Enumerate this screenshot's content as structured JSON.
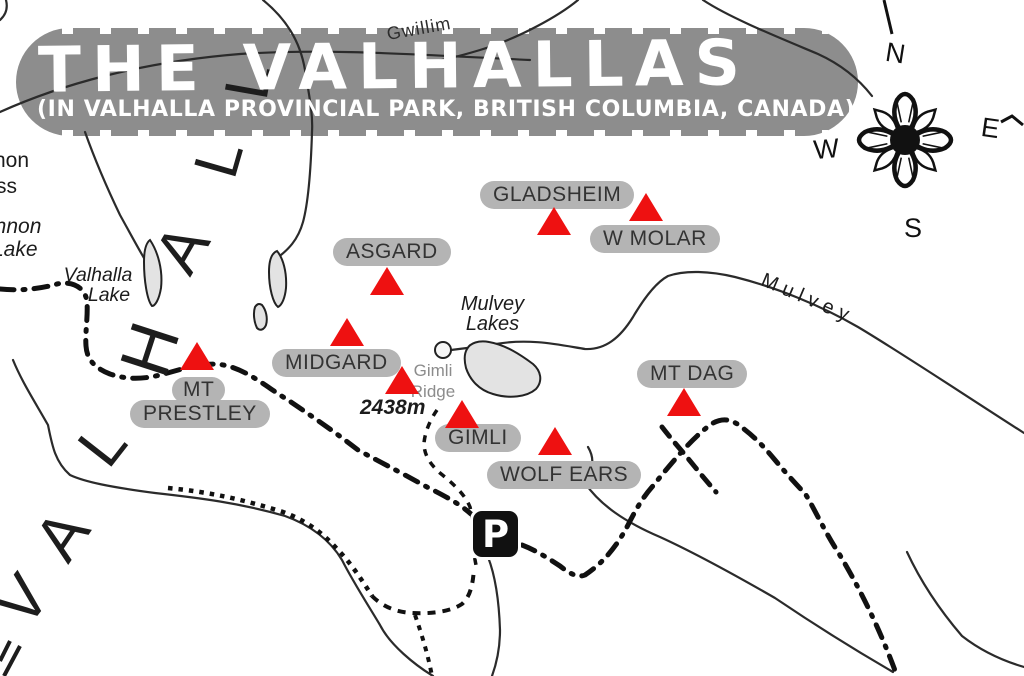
{
  "title": {
    "main": "THE VALHALLAS",
    "subtitle": "(IN VALHALLA PROVINCIAL PARK, BRITISH COLUMBIA, CANADA)"
  },
  "compass": {
    "n": "N",
    "e": "E",
    "s": "S",
    "w": "W"
  },
  "peaks": [
    {
      "id": "gladsheim",
      "label": "GLADSHEIM"
    },
    {
      "id": "w-molar",
      "label": "W MOLAR"
    },
    {
      "id": "asgard",
      "label": "ASGARD"
    },
    {
      "id": "midgard",
      "label": "MIDGARD"
    },
    {
      "id": "mt-prestley",
      "label_line1": "MT",
      "label_line2": "PRESTLEY"
    },
    {
      "id": "gimli-ridge",
      "name_line1": "Gimli",
      "name_line2": "Ridge",
      "elevation": "2438m"
    },
    {
      "id": "gimli",
      "label": "GIMLI"
    },
    {
      "id": "wolf-ears",
      "label": "WOLF EARS"
    },
    {
      "id": "mt-dag",
      "label": "MT DAG"
    }
  ],
  "water": {
    "mulvey_lakes_line1": "Mulvey",
    "mulvey_lakes_line2": "Lakes",
    "valhalla_lake_line1": "Valhalla",
    "valhalla_lake_line2": "Lake"
  },
  "creeks": {
    "mulvey_creek": "Mulvey",
    "gwillim_creek": "Gwillim"
  },
  "edge_labels": {
    "fragment_top": "non",
    "fragment_second": "ss",
    "fragment_lake_line1": "innon",
    "fragment_lake_line2": "Lake"
  },
  "big_letters": {
    "word": "VALHALLA",
    "visible_letters": [
      "L",
      "L",
      "A",
      "H",
      "L",
      "A",
      "V"
    ]
  },
  "parking": {
    "label": "P"
  },
  "colors": {
    "banner_gray": "#8d8d8d",
    "label_pill_gray": "#b4b4b4",
    "label_text": "#333333",
    "peak_red": "#ee1111",
    "lake_fill": "#e3e3e3",
    "line_black": "#1d1d1d",
    "title_white": "#ffffff"
  }
}
